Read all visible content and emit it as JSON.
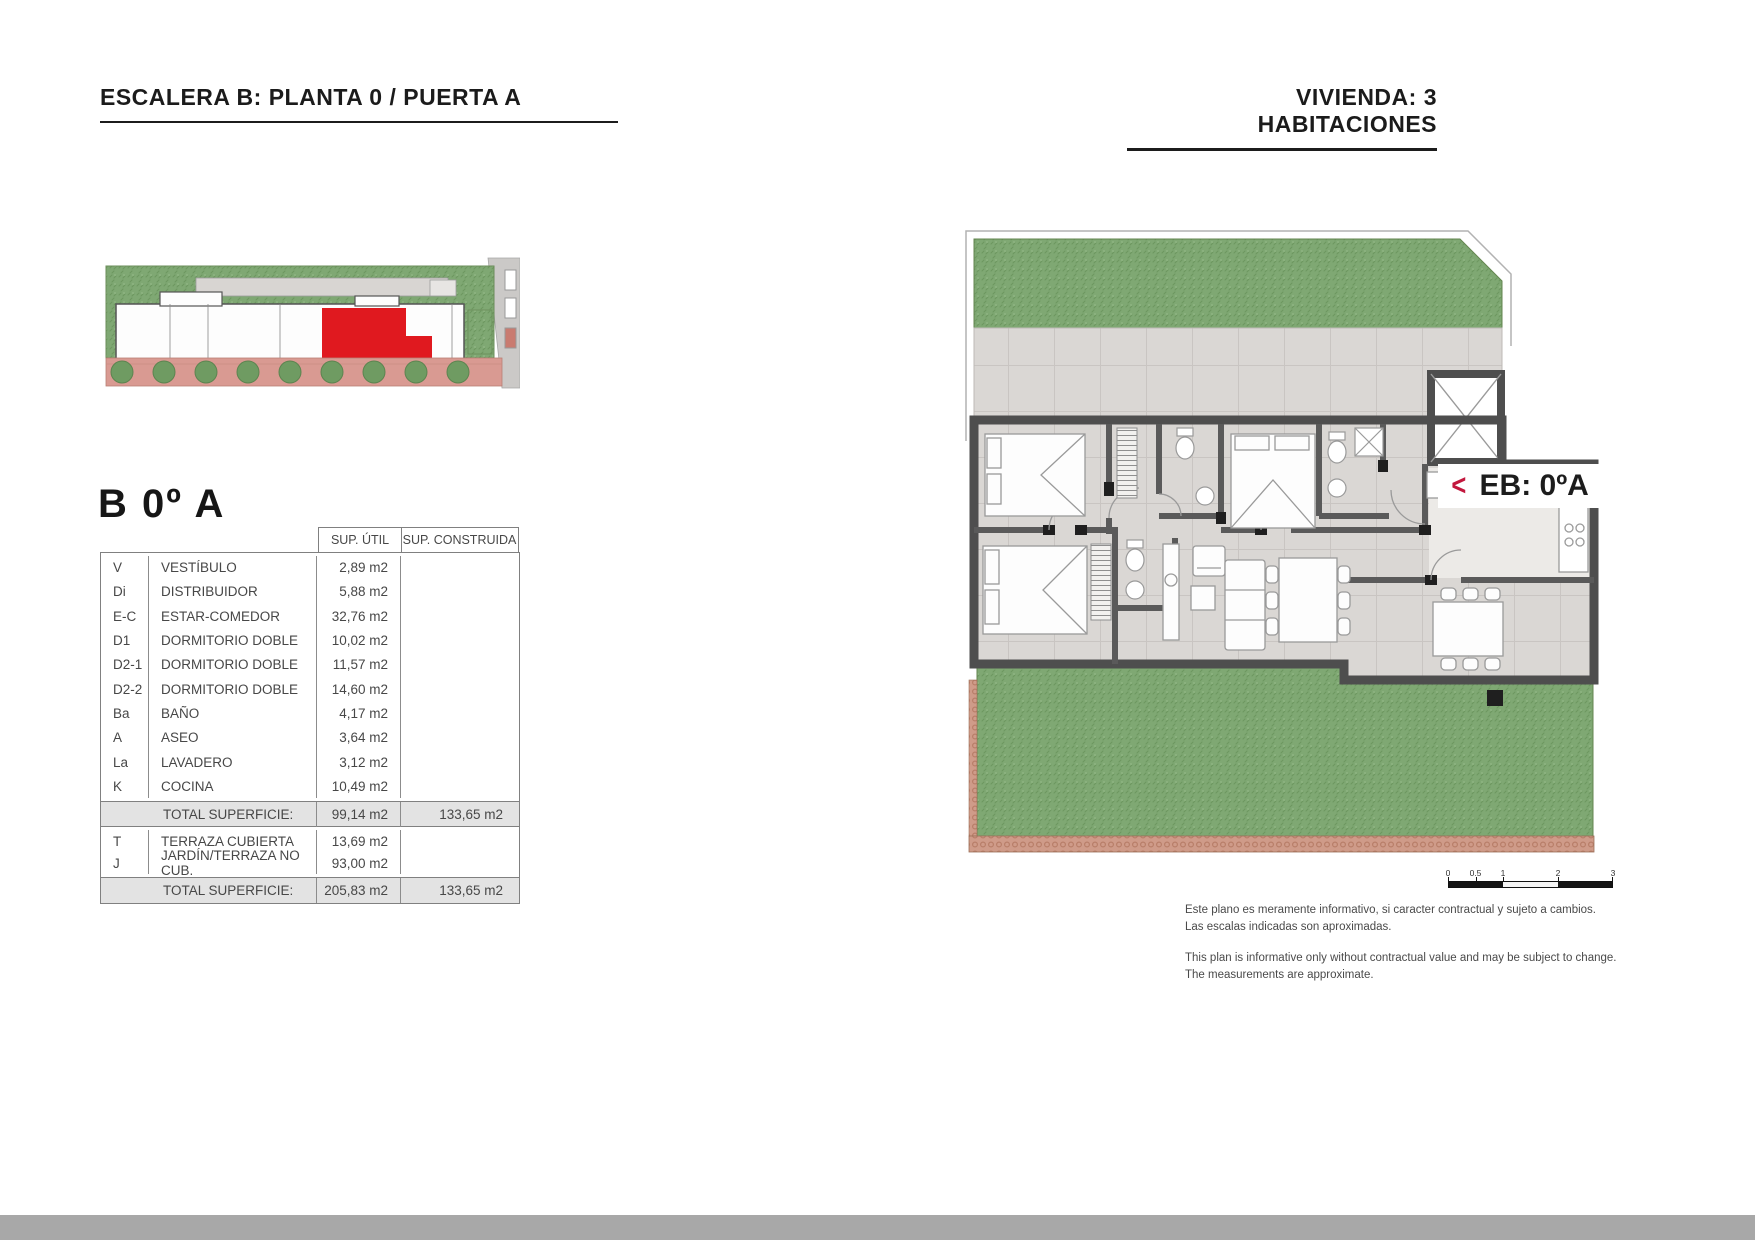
{
  "header": {
    "left_title": "ESCALERA B: PLANTA 0 / PUERTA A",
    "right_title": "VIVIENDA: 3 HABITACIONES"
  },
  "unit": {
    "title": "B 0º A",
    "plan_label": "EB: 0ºA",
    "plan_arrow": "<"
  },
  "table": {
    "columns": [
      "SUP. ÚTIL",
      "SUP. CONSTRUIDA"
    ],
    "rows": [
      {
        "code": "V",
        "name": "VESTÍBULO",
        "util": "2,89 m2",
        "construida": ""
      },
      {
        "code": "Di",
        "name": "DISTRIBUIDOR",
        "util": "5,88 m2",
        "construida": ""
      },
      {
        "code": "E-C",
        "name": "ESTAR-COMEDOR",
        "util": "32,76 m2",
        "construida": ""
      },
      {
        "code": "D1",
        "name": "DORMITORIO DOBLE",
        "util": "10,02 m2",
        "construida": ""
      },
      {
        "code": "D2-1",
        "name": "DORMITORIO DOBLE",
        "util": "11,57 m2",
        "construida": ""
      },
      {
        "code": "D2-2",
        "name": "DORMITORIO DOBLE",
        "util": "14,60 m2",
        "construida": ""
      },
      {
        "code": "Ba",
        "name": "BAÑO",
        "util": "4,17 m2",
        "construida": ""
      },
      {
        "code": "A",
        "name": "ASEO",
        "util": "3,64 m2",
        "construida": ""
      },
      {
        "code": "La",
        "name": "LAVADERO",
        "util": "3,12 m2",
        "construida": ""
      },
      {
        "code": "K",
        "name": "COCINA",
        "util": "10,49 m2",
        "construida": ""
      }
    ],
    "subtotal": {
      "label": "TOTAL SUPERFICIE:",
      "util": "99,14 m2",
      "construida": "133,65 m2"
    },
    "outdoor_rows": [
      {
        "code": "T",
        "name": "TERRAZA CUBIERTA",
        "util": "13,69 m2",
        "construida": ""
      },
      {
        "code": "J",
        "name": "JARDÍN/TERRAZA NO CUB.",
        "util": "93,00 m2",
        "construida": ""
      }
    ],
    "total": {
      "label": "TOTAL SUPERFICIE:",
      "util": "205,83 m2",
      "construida": "133,65 m2"
    }
  },
  "scalebar": {
    "ticks": [
      "0",
      "0.5",
      "1",
      "2",
      "3"
    ]
  },
  "disclaimer": {
    "es1": "Este plano es meramente informativo, si caracter contractual y sujeto a cambios.",
    "es2": "Las escalas indicadas son aproximadas.",
    "en1": "This plan is informative only without contractual value and may be subject to change.",
    "en2": "The measurements are approximate."
  },
  "colors": {
    "accent_red": "#c2173d",
    "highlight_unit_red": "#e0191f",
    "grass_green": "#7fa873",
    "wall_grey": "#4e4e4e",
    "brick": "#cf9b89"
  }
}
